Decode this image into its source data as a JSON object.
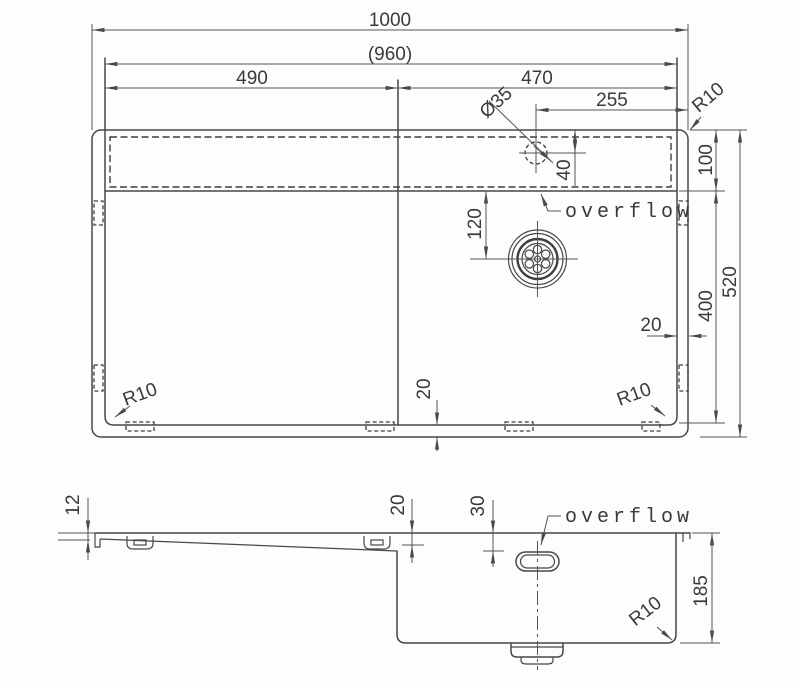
{
  "view_top": {
    "dim_overall_width": "1000",
    "dim_inner_width": "(960)",
    "dim_drainboard_width": "490",
    "dim_bowl_width": "470",
    "dim_faucet_offset": "255",
    "dim_faucet_hole": "Ø35",
    "dim_radius_top_right": "R10",
    "dim_deck_depth": "100",
    "dim_faucet_from_edge": "40",
    "dim_drain_offset": "120",
    "dim_bowl_length": "400",
    "dim_overall_depth": "520",
    "dim_rim_right": "20",
    "dim_rim_bottom": "20",
    "dim_radius_bottom_left": "R10",
    "dim_radius_bottom_right": "R10",
    "label_overflow": "overflow"
  },
  "view_side": {
    "dim_deck_thickness": "12",
    "dim_step_depth": "20",
    "dim_overflow_offset": "30",
    "label_overflow": "overflow",
    "dim_bowl_depth": "185",
    "dim_radius_bottom": "R10"
  },
  "style": {
    "line_color": "#474747",
    "dim_color": "#555555",
    "text_color": "#3a3a3a",
    "background": "#fdfdfd"
  }
}
